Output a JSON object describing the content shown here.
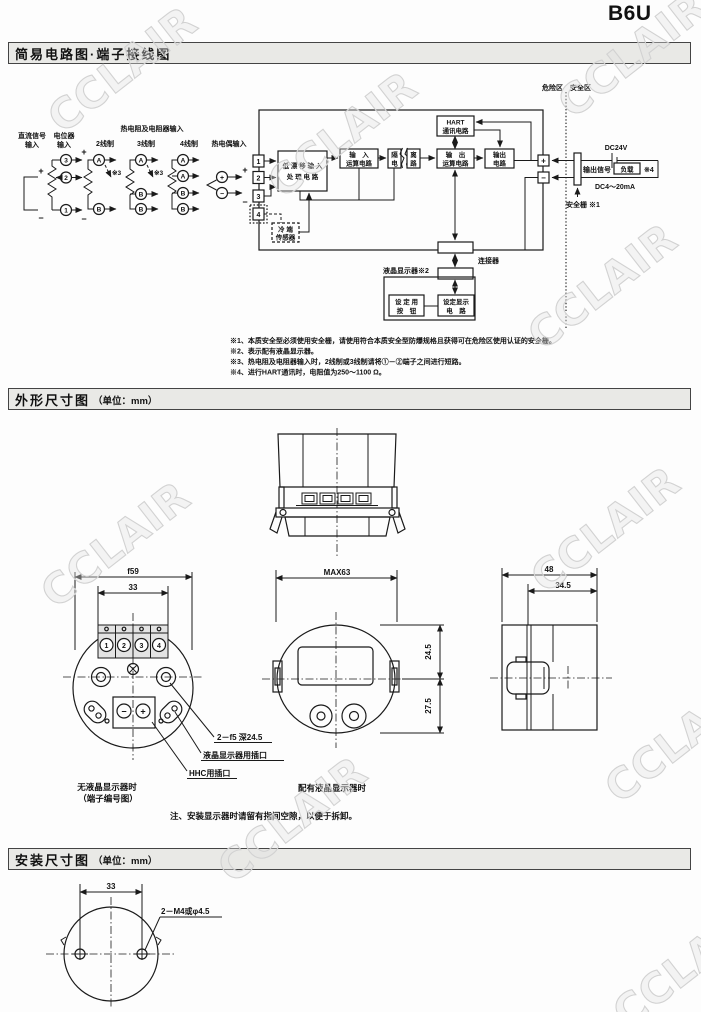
{
  "page": {
    "code": "B6U",
    "watermark": "CCLAIR"
  },
  "sections": {
    "circuit": {
      "title": "简易电路图·端子接线图"
    },
    "outline": {
      "title": "外形尺寸图",
      "unit": "（单位：mm）"
    },
    "mounting": {
      "title": "安装尺寸图",
      "unit": "（单位：mm）"
    }
  },
  "circuit": {
    "zone_left": "危险区",
    "zone_right": "安全区",
    "inputs": {
      "dc1": "直流信号",
      "dc2": "输入",
      "pot1": "电位器",
      "pot2": "输入",
      "rtd_header": "热电阻及电阻器输入",
      "wire2": "2线制",
      "wire3": "3线制",
      "wire4": "4线制",
      "tc": "热电偶输入",
      "note3": "※3",
      "a": "A",
      "b": "B",
      "n1": "1",
      "n2": "2",
      "n3": "3",
      "plus": "+",
      "minus": "−"
    },
    "terminals": {
      "t1": "1",
      "t2": "2",
      "t3": "3",
      "t4": "4"
    },
    "blocks": {
      "low_drift1": "低 漂 移 输 入",
      "low_drift2": "处 理 电 路",
      "input_calc1": "输　入",
      "input_calc2": "运算电路",
      "iso1a": "隔",
      "iso1b": "电",
      "iso2a": "离",
      "iso2b": "路",
      "hart1": "HART",
      "hart2": "通讯电路",
      "out_calc1": "输　出",
      "out_calc2": "运算电路",
      "out1": "输出",
      "out2": "电路",
      "cold1": "冷 端",
      "cold2": "传感器",
      "btn1": "设 定 用",
      "btn2": "按　钮",
      "disp1": "设定显示",
      "disp2": "电　路"
    },
    "labels": {
      "connector": "连接器",
      "lcd": "液晶显示器※2",
      "plus": "+",
      "minus": "−",
      "dc24v": "DC24V",
      "out_signal": "输出信号",
      "load": "负载",
      "note4": "※4",
      "range": "DC4～20mA",
      "barrier": "安全栅 ※1"
    },
    "notes": [
      "※1、本质安全型必须使用安全栅，请使用符合本质安全型防爆规格且获得可在危险区使用认证的安全栅。",
      "※2、表示配有液晶显示器。",
      "※3、热电阻及电阻器输入时，2线制或3线制请将①－②端子之间进行短路。",
      "※4、进行HART通讯时，电阻值为250～1100 Ω。"
    ]
  },
  "outline": {
    "front": {
      "dia": "f59",
      "width": "33",
      "t1": "1",
      "t2": "2",
      "t3": "3",
      "t4": "4",
      "minus": "−",
      "plus": "+",
      "label_holes": "2－f5 深24.5",
      "label_lcd": "液晶显示器用插口",
      "label_hhc": "HHC用插口",
      "cap1": "无液晶显示器时",
      "cap2": "（端子编号图）"
    },
    "lcd": {
      "width": "MAX63",
      "upper": "24.5",
      "lower": "27.5",
      "cap": "配有液晶显示器时"
    },
    "side": {
      "depth": "48",
      "inner": "34.5"
    },
    "note": "注、安装显示器时请留有指间空隙，以便于拆卸。"
  },
  "mount": {
    "width": "33",
    "holes": "2－M4或φ4.5"
  }
}
